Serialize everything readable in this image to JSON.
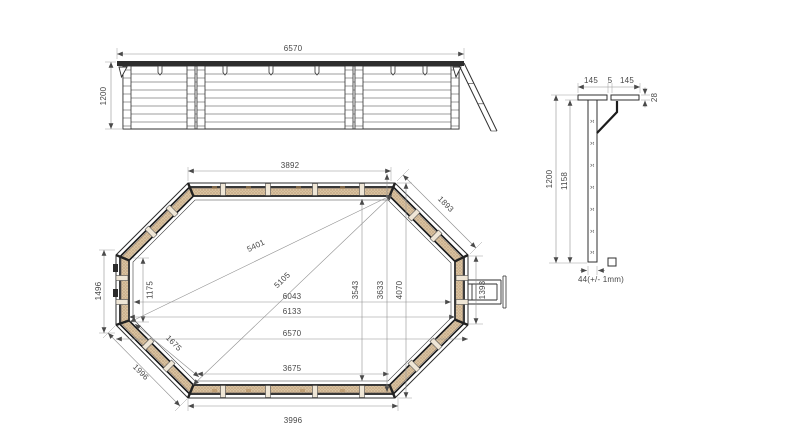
{
  "drawing": {
    "type": "technical-drawing-wooden-octagonal-pool",
    "elevation": {
      "length": "6570",
      "height": "1200"
    },
    "plan": {
      "top_edge": "3892",
      "top_right_edge": "1893",
      "left_edge": "1496",
      "bottom_left_edge": "1996",
      "bottom_edge": "3996",
      "left_inner_edge": "1175",
      "bottom_left_inner_edge": "1675",
      "diagonal_long": "5401",
      "diagonal_short": "5105",
      "inner_length": "6043",
      "mid_length": "6133",
      "outer_length": "6570",
      "bottom_inner_edge": "3675",
      "inner_width": "3543",
      "mid_width": "3633",
      "outer_width": "4070",
      "right_edge": "1393"
    },
    "section": {
      "coping_board_left": "145",
      "coping_gap": "5",
      "coping_board_right": "145",
      "coping_thickness": "28",
      "total_height": "1200",
      "wall_height": "1158",
      "plank_thickness": "44(+/- 1mm)"
    },
    "colors": {
      "wood_band": "#d9c2a0",
      "wood_dot": "#8a6642",
      "line": "#2f2f2f",
      "dimension_line": "#8f8f8f",
      "text": "#474747"
    }
  }
}
